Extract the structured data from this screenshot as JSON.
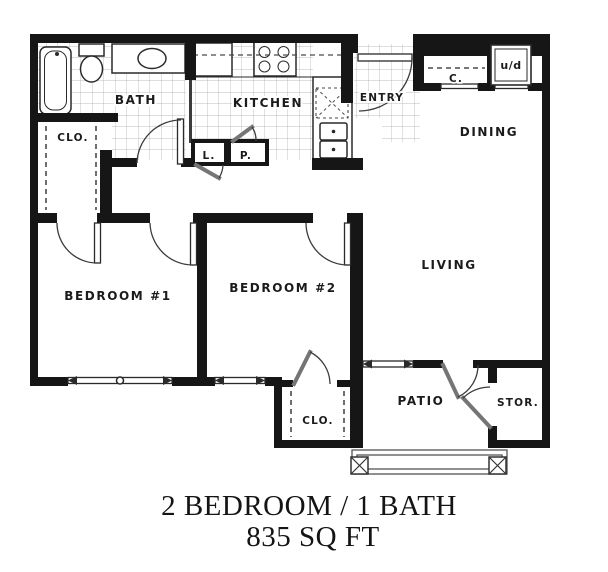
{
  "title": {
    "line1": "2 BEDROOM / 1 BATH",
    "line2": "835 SQ FT"
  },
  "rooms": {
    "bath": "BATH",
    "kitchen": "KITCHEN",
    "entry": "ENTRY",
    "dining": "DINING",
    "living": "LIVING",
    "bedroom1": "BEDROOM #1",
    "bedroom2": "BEDROOM #2",
    "patio": "PATIO",
    "storage": "STOR.",
    "closet_hall": "CLO.",
    "closet_bedroom2": "CLO.",
    "linen": "L.",
    "pantry": "P.",
    "coat_closet": "C.",
    "washer_dryer": "u/d"
  },
  "colors": {
    "wall": "#161616",
    "line": "#3c3c3c",
    "leaf": "#757575",
    "fixture": "#2a2a2a",
    "tile": "#a9a9a9",
    "text": "#1b1b1b",
    "background": "#ffffff"
  }
}
